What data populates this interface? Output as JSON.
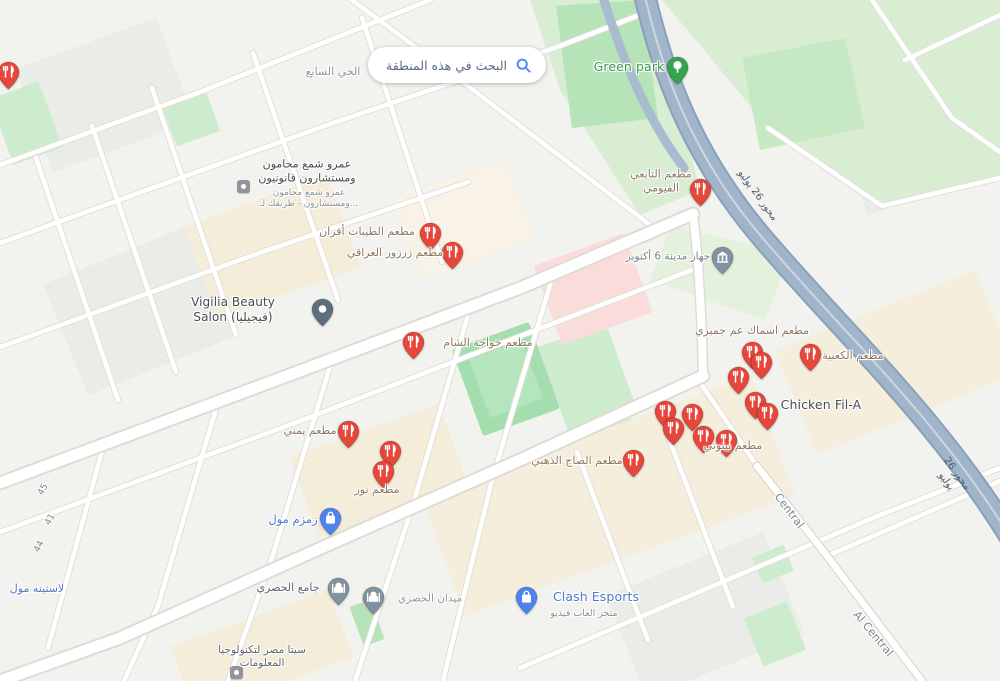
{
  "search_button": {
    "label": "البحث في هذه المنطقة",
    "icon": "search-icon"
  },
  "colors": {
    "accent_blue": "#4e8df7",
    "pin_restaurant": "#e7463a",
    "pin_mall": "#4f83ec",
    "pin_park": "#35a24e",
    "pin_civic": "#8193a3",
    "pin_dark": "#5d6f7c",
    "label_food": "#8f7862",
    "label_mall": "#5077c8",
    "label_park": "#3d9950",
    "highway_fill": "#9fb3c9"
  },
  "map": {
    "pins": [
      {
        "kind": "restaurant",
        "x": 8,
        "y": 72,
        "name": "pin-restaurant-edge"
      },
      {
        "kind": "restaurant",
        "x": 430,
        "y": 233,
        "name": "pin-matam-altayibat"
      },
      {
        "kind": "restaurant",
        "x": 452,
        "y": 252,
        "name": "pin-matam-zarzour"
      },
      {
        "kind": "restaurant",
        "x": 700,
        "y": 189,
        "name": "pin-matam-altabei"
      },
      {
        "kind": "restaurant",
        "x": 413,
        "y": 342,
        "name": "pin-matam-khawaga"
      },
      {
        "kind": "restaurant",
        "x": 348,
        "y": 431,
        "name": "pin-matam-yamani"
      },
      {
        "kind": "restaurant",
        "x": 390,
        "y": 451,
        "name": "pin-restaurant-cluster-a"
      },
      {
        "kind": "restaurant",
        "x": 383,
        "y": 471,
        "name": "pin-matam-nour"
      },
      {
        "kind": "restaurant",
        "x": 633,
        "y": 460,
        "name": "pin-matam-alsaj"
      },
      {
        "kind": "restaurant",
        "x": 752,
        "y": 352,
        "name": "pin-restaurant-cluster-b1"
      },
      {
        "kind": "restaurant",
        "x": 761,
        "y": 362,
        "name": "pin-restaurant-cluster-b2"
      },
      {
        "kind": "restaurant",
        "x": 738,
        "y": 377,
        "name": "pin-restaurant-cluster-b3"
      },
      {
        "kind": "restaurant",
        "x": 810,
        "y": 354,
        "name": "pin-matam-alkaabia"
      },
      {
        "kind": "restaurant",
        "x": 755,
        "y": 402,
        "name": "pin-restaurant-cluster-b4"
      },
      {
        "kind": "restaurant",
        "x": 767,
        "y": 413,
        "name": "pin-chicken-fil-a"
      },
      {
        "kind": "restaurant",
        "x": 665,
        "y": 411,
        "name": "pin-restaurant-cluster-c1"
      },
      {
        "kind": "restaurant",
        "x": 692,
        "y": 414,
        "name": "pin-restaurant-cluster-c2"
      },
      {
        "kind": "restaurant",
        "x": 673,
        "y": 428,
        "name": "pin-restaurant-cluster-c3"
      },
      {
        "kind": "restaurant",
        "x": 703,
        "y": 436,
        "name": "pin-matam-bitoti"
      },
      {
        "kind": "restaurant",
        "x": 726,
        "y": 440,
        "name": "pin-restaurant-cluster-c4"
      },
      {
        "kind": "park",
        "x": 677,
        "y": 67,
        "name": "pin-green-park"
      },
      {
        "kind": "civic",
        "x": 722,
        "y": 257,
        "name": "pin-october-city-authority"
      },
      {
        "kind": "generic",
        "x": 322,
        "y": 309,
        "name": "pin-vigilia-salon"
      },
      {
        "kind": "mall",
        "x": 330,
        "y": 518,
        "name": "pin-zamzam-mall"
      },
      {
        "kind": "mosque",
        "x": 338,
        "y": 588,
        "name": "pin-hosary-mosque"
      },
      {
        "kind": "mosque",
        "x": 373,
        "y": 597,
        "name": "pin-hosary-square"
      },
      {
        "kind": "mall",
        "x": 526,
        "y": 597,
        "name": "pin-clash-esports"
      },
      {
        "kind": "biz",
        "x": 243,
        "y": 186,
        "name": "icon-amr-shamaa-office"
      },
      {
        "kind": "biz",
        "x": 236,
        "y": 672,
        "name": "icon-sita-egypt"
      }
    ],
    "labels": [
      {
        "text": "الحي السابع",
        "x": 333,
        "y": 72,
        "cls": "district",
        "size": 11,
        "name": "district-label-seventh",
        "inter": false
      },
      {
        "text": "عمرو شمع محامون\nومستشارون قانونيون",
        "x": 307,
        "y": 171,
        "cls": "poi-dark",
        "size": 11,
        "name": "poi-label-amr-shamaa",
        "inter": true
      },
      {
        "text": "عمرو شمع محامون\nومستشارون - طريقك لـ...",
        "x": 309,
        "y": 199,
        "cls": "poi-sub",
        "size": 9,
        "name": "poi-sublabel-amr-shamaa",
        "inter": false
      },
      {
        "text": "مطعم الطيبات أفران",
        "x": 367,
        "y": 232,
        "cls": "poi-food",
        "size": 11,
        "name": "poi-label-altayibat",
        "inter": true
      },
      {
        "text": "مطعم زرزور العراقي",
        "x": 395,
        "y": 253,
        "cls": "poi-food",
        "size": 11,
        "name": "poi-label-zarzour",
        "inter": true
      },
      {
        "text": "مطعم التابعي\nالفيومي",
        "x": 661,
        "y": 181,
        "cls": "poi-food",
        "size": 11,
        "name": "poi-label-altabei",
        "inter": true
      },
      {
        "text": "Green park",
        "x": 629,
        "y": 67,
        "cls": "park",
        "size": 12.5,
        "name": "poi-label-green-park",
        "inter": true
      },
      {
        "text": "جهاز مدينة 6 أكتوبر",
        "x": 668,
        "y": 257,
        "cls": "civic",
        "size": 10.5,
        "name": "poi-label-city-authority",
        "inter": true
      },
      {
        "text": "Vigilia Beauty\nSalon (فيجيليا)",
        "x": 233,
        "y": 310,
        "cls": "poi-dark",
        "size": 12,
        "name": "poi-label-vigilia",
        "inter": true
      },
      {
        "text": "مطعم خواجة الشام",
        "x": 488,
        "y": 343,
        "cls": "poi-food",
        "size": 11,
        "name": "poi-label-khawaga",
        "inter": true
      },
      {
        "text": "مطعم اسماك عم جمبري",
        "x": 752,
        "y": 331,
        "cls": "poi-food",
        "size": 11,
        "name": "poi-label-asmak-gambary",
        "inter": true
      },
      {
        "text": "مطعم الكعبية",
        "x": 853,
        "y": 356,
        "cls": "poi-food",
        "size": 11,
        "name": "poi-label-alkaabia",
        "inter": true
      },
      {
        "text": "Chicken Fil-A",
        "x": 821,
        "y": 405,
        "cls": "poi-dark",
        "size": 12.5,
        "name": "poi-label-chicken-fil-a",
        "inter": true
      },
      {
        "text": "مطعم بيتوتي",
        "x": 733,
        "y": 446,
        "cls": "poi-food",
        "size": 11,
        "name": "poi-label-bitoti",
        "inter": true
      },
      {
        "text": "مطعم يمني",
        "x": 310,
        "y": 431,
        "cls": "poi-food",
        "size": 11,
        "name": "poi-label-yamani",
        "inter": true
      },
      {
        "text": "مطعم نور",
        "x": 377,
        "y": 490,
        "cls": "poi-food",
        "size": 11,
        "name": "poi-label-nour",
        "inter": true
      },
      {
        "text": "مطعم الصاج الذهبي",
        "x": 577,
        "y": 461,
        "cls": "poi-food",
        "size": 11,
        "name": "poi-label-alsaj-aldahabi",
        "inter": true
      },
      {
        "text": "زمزم مول",
        "x": 293,
        "y": 519,
        "cls": "mall",
        "size": 11.5,
        "name": "poi-label-zamzam-mall",
        "inter": true
      },
      {
        "text": "لاستينه مول",
        "x": 37,
        "y": 589,
        "cls": "mall",
        "size": 11,
        "name": "poi-label-lastina-mall",
        "inter": true
      },
      {
        "text": "جامع الحصري",
        "x": 288,
        "y": 588,
        "cls": "poi-gray",
        "size": 11,
        "name": "poi-label-hosary-mosque",
        "inter": true
      },
      {
        "text": "ميدان الحصري",
        "x": 430,
        "y": 599,
        "cls": "district",
        "size": 10.5,
        "name": "label-hosary-square",
        "inter": false
      },
      {
        "text": "Clash Esports",
        "x": 596,
        "y": 597,
        "cls": "mall",
        "size": 12.5,
        "name": "poi-label-clash-esports",
        "inter": true
      },
      {
        "text": "متجر العاب فيديو",
        "x": 584,
        "y": 614,
        "cls": "poi-sub",
        "size": 9.5,
        "name": "poi-sublabel-clash-esports",
        "inter": false
      },
      {
        "text": "سيتا مصر لتكنولوجيا\nالمعلومات",
        "x": 262,
        "y": 657,
        "cls": "poi-gray",
        "size": 10.5,
        "name": "poi-label-sita-egypt",
        "inter": true
      },
      {
        "text": "محور 26 يوليو",
        "x": 757,
        "y": 196,
        "cls": "hwy",
        "size": 10,
        "rot": 54,
        "name": "road-label-26-july-corridor-1",
        "inter": false
      },
      {
        "text": "محور 26 يوليو",
        "x": 951,
        "y": 478,
        "cls": "hwy",
        "size": 10,
        "rot": 54,
        "name": "road-label-26-july-corridor-2",
        "inter": false
      },
      {
        "text": "Central",
        "x": 789,
        "y": 511,
        "cls": "road",
        "size": 11,
        "rot": 53,
        "name": "road-label-central",
        "inter": false
      },
      {
        "text": "Al Central",
        "x": 873,
        "y": 634,
        "cls": "road",
        "size": 11,
        "rot": 50,
        "name": "road-label-al-central",
        "inter": false
      },
      {
        "text": "45",
        "x": 44,
        "y": 490,
        "cls": "road",
        "size": 9,
        "rot": -62,
        "name": "road-label-45",
        "inter": false
      },
      {
        "text": "41",
        "x": 51,
        "y": 520,
        "cls": "road",
        "size": 9,
        "rot": -62,
        "name": "road-label-41",
        "inter": false
      },
      {
        "text": "44",
        "x": 40,
        "y": 547,
        "cls": "road",
        "size": 9,
        "rot": -62,
        "name": "road-label-44",
        "inter": false
      }
    ]
  }
}
